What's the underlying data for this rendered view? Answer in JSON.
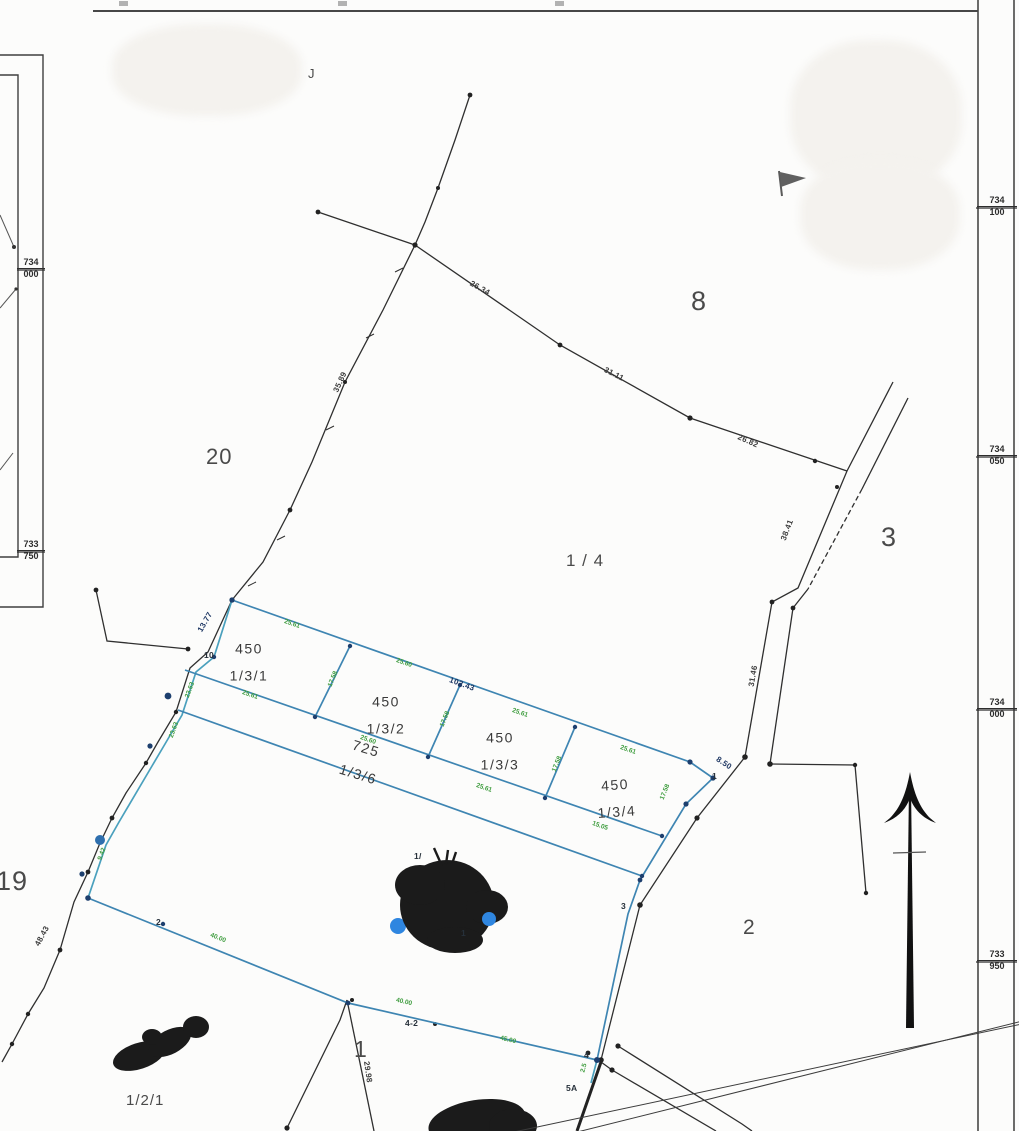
{
  "canvas": {
    "width": 1019,
    "height": 1131,
    "background": "#fcfcfb"
  },
  "palette": {
    "black_line": "#2f2f2f",
    "frame_line": "#474747",
    "blue_line": "#3e85b2",
    "teal_line": "#4aa0bd",
    "green_text": "#3f9d3f",
    "navy_text": "#1f3864",
    "dark_text": "#3c3c3c",
    "blue_dot": "#2f86e0",
    "redaction": "#1b1b1b"
  },
  "frame": {
    "right_coord_labels": [
      {
        "top": "734",
        "bottom": "100",
        "y": 208
      },
      {
        "top": "734",
        "bottom": "050",
        "y": 457
      },
      {
        "top": "734",
        "bottom": "000",
        "y": 710
      },
      {
        "top": "733",
        "bottom": "950",
        "y": 962
      }
    ],
    "inset_coord_labels": [
      {
        "top": "734",
        "bottom": "000",
        "y": 270
      },
      {
        "top": "733",
        "bottom": "750",
        "y": 552
      }
    ]
  },
  "region_labels": [
    {
      "text": "J",
      "x": 308,
      "y": 66,
      "size": 13
    },
    {
      "text": "20",
      "x": 206,
      "y": 444,
      "size": 22
    },
    {
      "text": "8",
      "x": 691,
      "y": 286,
      "size": 27
    },
    {
      "text": "3",
      "x": 881,
      "y": 522,
      "size": 27
    },
    {
      "text": "1 / 4",
      "x": 566,
      "y": 551,
      "size": 17
    },
    {
      "text": "19",
      "x": -4,
      "y": 866,
      "size": 27
    },
    {
      "text": "2",
      "x": 743,
      "y": 916,
      "size": 21
    },
    {
      "text": "1",
      "x": 354,
      "y": 1036,
      "size": 23
    },
    {
      "text": "1/2",
      "x": 272,
      "y": 1066,
      "size": 16,
      "rot": -8,
      "strike": true
    },
    {
      "text": "1/2/1",
      "x": 126,
      "y": 1092,
      "size": 15
    }
  ],
  "parcel_labels": [
    {
      "line1": "450",
      "line2": "1/3/1",
      "x": 249,
      "y": 663,
      "rot": 0
    },
    {
      "line1": "450",
      "line2": "1/3/2",
      "x": 386,
      "y": 716,
      "rot": 0
    },
    {
      "line1": "450",
      "line2": "1/3/3",
      "x": 500,
      "y": 752,
      "rot": 0
    },
    {
      "line1": "450",
      "line2": "1/3/4",
      "x": 616,
      "y": 799,
      "rot": -4
    },
    {
      "line1": "725",
      "line2": "1/3/6",
      "x": 362,
      "y": 762,
      "rot": 17
    }
  ],
  "point_labels": [
    {
      "text": "10",
      "x": 204,
      "y": 650
    },
    {
      "text": "1",
      "x": 712,
      "y": 771
    },
    {
      "text": "3",
      "x": 621,
      "y": 901
    },
    {
      "text": "4",
      "x": 584,
      "y": 1050
    },
    {
      "text": "5A",
      "x": 566,
      "y": 1083
    },
    {
      "text": "4-2",
      "x": 405,
      "y": 1018
    },
    {
      "text": "2",
      "x": 156,
      "y": 917
    },
    {
      "text": "1/",
      "x": 414,
      "y": 851
    },
    {
      "text": "1",
      "x": 461,
      "y": 928
    }
  ],
  "dimension_labels": [
    {
      "text": "26.34",
      "x": 480,
      "y": 288,
      "rot": 29,
      "color": "dark"
    },
    {
      "text": "31.11",
      "x": 614,
      "y": 374,
      "rot": 27,
      "color": "dark"
    },
    {
      "text": "26.82",
      "x": 748,
      "y": 441,
      "rot": 24,
      "color": "dark"
    },
    {
      "text": "38.41",
      "x": 787,
      "y": 530,
      "rot": -69,
      "color": "dark"
    },
    {
      "text": "31.46",
      "x": 753,
      "y": 676,
      "rot": -80,
      "color": "dark"
    },
    {
      "text": "35.89",
      "x": 340,
      "y": 382,
      "rot": -65,
      "color": "dark"
    },
    {
      "text": "48.43",
      "x": 42,
      "y": 936,
      "rot": -62,
      "color": "dark"
    },
    {
      "text": "29.98",
      "x": 368,
      "y": 1072,
      "rot": 82,
      "color": "dark"
    },
    {
      "text": "13.77",
      "x": 205,
      "y": 622,
      "rot": -60,
      "color": "navy"
    },
    {
      "text": "102.43",
      "x": 462,
      "y": 684,
      "rot": 20,
      "color": "navy"
    },
    {
      "text": "8.50",
      "x": 724,
      "y": 763,
      "rot": 33,
      "color": "navy"
    }
  ],
  "small_dims_green": [
    {
      "text": "25.61",
      "x": 292,
      "y": 624,
      "rot": 19
    },
    {
      "text": "25.60",
      "x": 404,
      "y": 663,
      "rot": 19
    },
    {
      "text": "25.61",
      "x": 520,
      "y": 713,
      "rot": 19
    },
    {
      "text": "25.61",
      "x": 628,
      "y": 750,
      "rot": 19
    },
    {
      "text": "17.58",
      "x": 333,
      "y": 679,
      "rot": -68
    },
    {
      "text": "17.58",
      "x": 445,
      "y": 719,
      "rot": -68
    },
    {
      "text": "17.58",
      "x": 557,
      "y": 764,
      "rot": -68
    },
    {
      "text": "17.58",
      "x": 665,
      "y": 792,
      "rot": -68
    },
    {
      "text": "25.61",
      "x": 250,
      "y": 695,
      "rot": 19
    },
    {
      "text": "25.60",
      "x": 368,
      "y": 740,
      "rot": 19
    },
    {
      "text": "25.61",
      "x": 484,
      "y": 788,
      "rot": 19
    },
    {
      "text": "15.05",
      "x": 600,
      "y": 826,
      "rot": 19
    },
    {
      "text": "23.63",
      "x": 190,
      "y": 690,
      "rot": -70
    },
    {
      "text": "23.63",
      "x": 174,
      "y": 730,
      "rot": -70
    },
    {
      "text": "9.42",
      "x": 102,
      "y": 854,
      "rot": -70
    },
    {
      "text": "40.00",
      "x": 218,
      "y": 938,
      "rot": 22
    },
    {
      "text": "40.00",
      "x": 404,
      "y": 1002,
      "rot": 13
    },
    {
      "text": "45.00",
      "x": 508,
      "y": 1040,
      "rot": 14
    },
    {
      "text": "2.5",
      "x": 584,
      "y": 1068,
      "rot": -75
    }
  ]
}
